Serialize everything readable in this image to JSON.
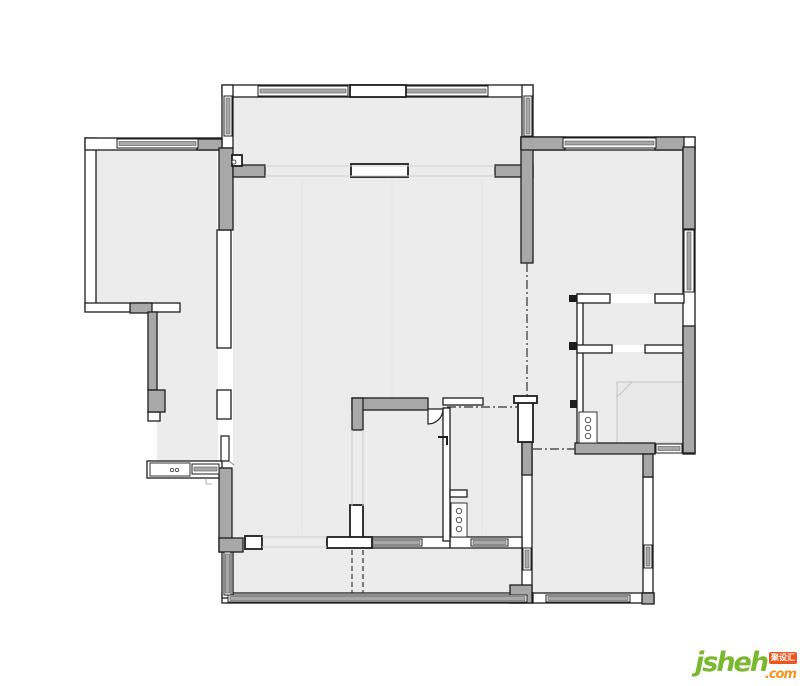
{
  "colors": {
    "floor": "#ececec",
    "wall_gray": "#a8a8a8",
    "line": "#1d1d1d",
    "glass": "#a8a8a8",
    "faint": "#cfcfcf",
    "seam": "#e3e3e3",
    "shower_fill": "#e9e9e9",
    "shower_line": "#c4c4c4",
    "logo_green": "#7cb82f",
    "logo_orange": "#f7941d",
    "logo_badge_bg": "#f0541e"
  },
  "logo": {
    "name": "jsheh",
    "tld": ".com",
    "badge": "聚设汇"
  },
  "plan": {
    "floors": [
      [
        234,
        97,
        288,
        68
      ],
      [
        96,
        150,
        121,
        153
      ],
      [
        233,
        165,
        300,
        383
      ],
      [
        533,
        150,
        150,
        144
      ],
      [
        533,
        294,
        44,
        161
      ],
      [
        583,
        303,
        100,
        42
      ],
      [
        583,
        352,
        100,
        91
      ],
      [
        532,
        455,
        111,
        138
      ],
      [
        157,
        303,
        61,
        159
      ],
      [
        233,
        548,
        289,
        45
      ]
    ],
    "seam_lines": [
      [
        302,
        180,
        302,
        534
      ],
      [
        392,
        180,
        392,
        396
      ],
      [
        482,
        180,
        482,
        534
      ]
    ],
    "shower": [
      617,
      382,
      66,
      61
    ],
    "white_walls": [
      [
        85,
        138,
        11,
        170
      ],
      [
        85,
        138,
        137,
        12
      ],
      [
        85,
        303,
        95,
        9
      ],
      [
        217,
        230,
        14,
        118
      ],
      [
        217,
        390,
        14,
        29
      ],
      [
        222,
        85,
        311,
        12
      ],
      [
        222,
        85,
        11,
        63
      ],
      [
        522,
        85,
        11,
        52
      ],
      [
        521,
        137,
        174,
        13
      ],
      [
        683,
        137,
        12,
        317
      ],
      [
        577,
        294,
        6,
        149
      ],
      [
        577,
        294,
        33,
        9
      ],
      [
        655,
        294,
        29,
        9
      ],
      [
        577,
        345,
        35,
        8
      ],
      [
        645,
        345,
        40,
        8
      ],
      [
        643,
        477,
        10,
        116
      ],
      [
        532,
        593,
        122,
        10
      ],
      [
        522,
        442,
        10,
        151
      ],
      [
        363,
        537,
        87,
        11
      ],
      [
        450,
        537,
        72,
        11
      ],
      [
        443,
        408,
        7,
        133
      ],
      [
        450,
        490,
        17,
        7
      ],
      [
        443,
        398,
        40,
        7
      ],
      [
        222,
        593,
        311,
        10
      ],
      [
        222,
        548,
        11,
        50
      ],
      [
        147,
        461,
        75,
        17
      ],
      [
        148,
        412,
        12,
        9
      ]
    ],
    "gray_walls": [
      [
        197,
        139,
        25,
        11
      ],
      [
        219,
        148,
        14,
        82
      ],
      [
        233,
        165,
        32,
        12
      ],
      [
        495,
        165,
        38,
        12
      ],
      [
        521,
        137,
        12,
        126
      ],
      [
        521,
        137,
        44,
        13
      ],
      [
        655,
        137,
        29,
        13
      ],
      [
        683,
        147,
        12,
        82
      ],
      [
        683,
        326,
        12,
        127
      ],
      [
        575,
        443,
        80,
        11
      ],
      [
        643,
        454,
        10,
        23
      ],
      [
        219,
        468,
        13,
        84
      ],
      [
        219,
        538,
        24,
        14
      ],
      [
        510,
        585,
        22,
        18
      ],
      [
        352,
        398,
        76,
        12
      ],
      [
        352,
        398,
        11,
        32
      ],
      [
        130,
        303,
        22,
        10
      ],
      [
        148,
        312,
        9,
        78
      ],
      [
        148,
        390,
        17,
        22
      ],
      [
        522,
        442,
        10,
        33
      ],
      [
        642,
        593,
        12,
        11
      ]
    ],
    "windows": [
      [
        258,
        86,
        90,
        10
      ],
      [
        404,
        86,
        84,
        10
      ],
      [
        224,
        96,
        8,
        40
      ],
      [
        524,
        96,
        8,
        40
      ],
      [
        117,
        139,
        81,
        9
      ],
      [
        563,
        138,
        93,
        10
      ],
      [
        684,
        230,
        10,
        62
      ],
      [
        656,
        444,
        26,
        9
      ],
      [
        644,
        545,
        8,
        23
      ],
      [
        546,
        595,
        84,
        7
      ],
      [
        523,
        548,
        8,
        22
      ],
      [
        371,
        539,
        51,
        7
      ],
      [
        471,
        539,
        37,
        7
      ],
      [
        228,
        595,
        299,
        7
      ],
      [
        224,
        552,
        7,
        43
      ],
      [
        192,
        464,
        27,
        10
      ]
    ],
    "bold_rects": [
      [
        350,
        85,
        56,
        12
      ],
      [
        351,
        164,
        57,
        13
      ],
      [
        245,
        536,
        17,
        13
      ],
      [
        350,
        505,
        13,
        33
      ],
      [
        327,
        537,
        45,
        11
      ],
      [
        518,
        398,
        15,
        44
      ],
      [
        514,
        396,
        23,
        7
      ],
      [
        232,
        155,
        10,
        11
      ]
    ],
    "black_rects": [
      [
        569,
        295,
        8,
        7
      ],
      [
        569,
        342,
        8,
        8
      ],
      [
        570,
        400,
        7,
        8
      ]
    ],
    "faint_lines": [
      [
        265,
        166,
        495,
        166
      ],
      [
        265,
        176,
        495,
        176
      ],
      [
        262,
        537,
        327,
        537
      ],
      [
        262,
        547,
        327,
        547
      ]
    ],
    "dash_lines": [
      [
        352,
        550,
        352,
        593
      ],
      [
        363,
        550,
        363,
        593
      ]
    ],
    "dashdot_lines": [
      [
        527,
        263,
        527,
        397
      ],
      [
        447,
        407,
        518,
        407
      ],
      [
        533,
        449,
        575,
        449
      ]
    ],
    "paths": [
      {
        "d": "M 428 409 L 443 409 A 15 15 0 0 1 428 424 Z",
        "f": "#ffffff",
        "w": 1.2
      },
      {
        "d": "M 438 437 L 447 437 L 447 445",
        "w": 2
      },
      {
        "d": "M 221 436 L 229 436 L 229 461 L 221 461 Z",
        "f": "#ffffff",
        "w": 1.2
      },
      {
        "d": "M 229 461 L 234 465",
        "s": "#888888",
        "w": 1
      },
      {
        "d": "M 617 397 L 632 382",
        "s": "#c4c4c4",
        "w": 1
      },
      {
        "d": "M 352 430 L 352 506 M 363 430 L 363 506",
        "s": "#c9c9c9",
        "w": 1
      },
      {
        "d": "M 206 478 L 206 484 L 212 484",
        "s": "#999999",
        "w": 0.8
      }
    ],
    "fixture_rects": [
      [
        579,
        412,
        18,
        31
      ],
      [
        451,
        503,
        16,
        34
      ],
      [
        150,
        463,
        40,
        13
      ]
    ],
    "circles": [
      [
        588,
        420,
        2.7
      ],
      [
        588,
        428,
        2.7
      ],
      [
        588,
        436,
        2.7
      ],
      [
        459,
        511,
        2.7
      ],
      [
        459,
        520,
        2.7
      ],
      [
        459,
        529,
        2.7
      ],
      [
        172,
        470,
        1.7
      ],
      [
        177,
        470,
        1.7
      ],
      [
        234,
        162,
        2
      ]
    ]
  }
}
